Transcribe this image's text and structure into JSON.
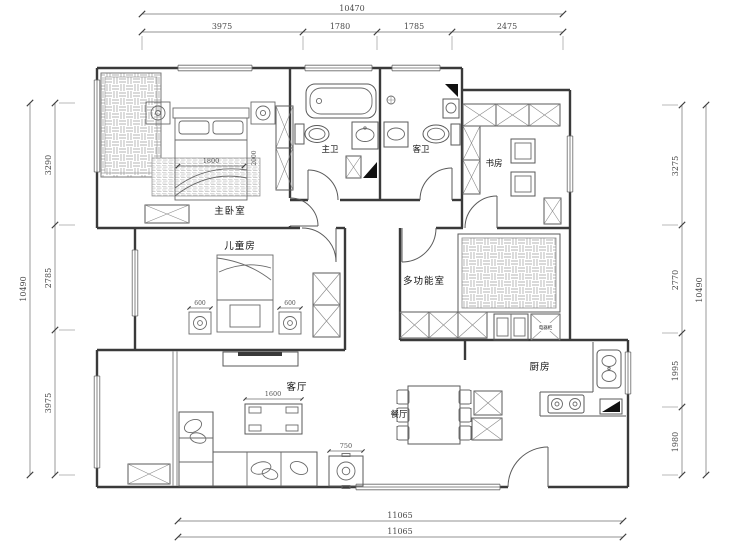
{
  "drawing": {
    "kind": "apartment floor plan",
    "background": "#ffffff",
    "wall_color": "#3a3a3a",
    "line_color": "#6a6a6a"
  },
  "rooms": {
    "master_bedroom": "主卧室",
    "master_bath": "主卫",
    "guest_bath": "客卫",
    "study": "书房",
    "kids_room": "儿童房",
    "multi_room": "多功能室",
    "kitchen": "厨房",
    "dining": "餐厅",
    "living": "客厅",
    "appliance_cabinet": "电器柜"
  },
  "dims": {
    "top": {
      "overall": "10470",
      "seg1": "3975",
      "seg2": "1780",
      "seg3": "1785",
      "seg4": "2475"
    },
    "left": {
      "overall": "10490",
      "seg1": "3290",
      "seg2": "2785",
      "seg3": "3975"
    },
    "right": {
      "overall": "10490",
      "seg1": "3275",
      "seg2": "2770",
      "seg3": "1995",
      "seg4": "1980"
    },
    "bottom": {
      "line1": "11065",
      "line2": "11065"
    },
    "furniture": {
      "bed_width": "1800",
      "bed_length": "2000",
      "kids_nightstand_left": "600",
      "kids_nightstand_right": "600",
      "coffee_table": "1600",
      "side_table": "750"
    }
  }
}
